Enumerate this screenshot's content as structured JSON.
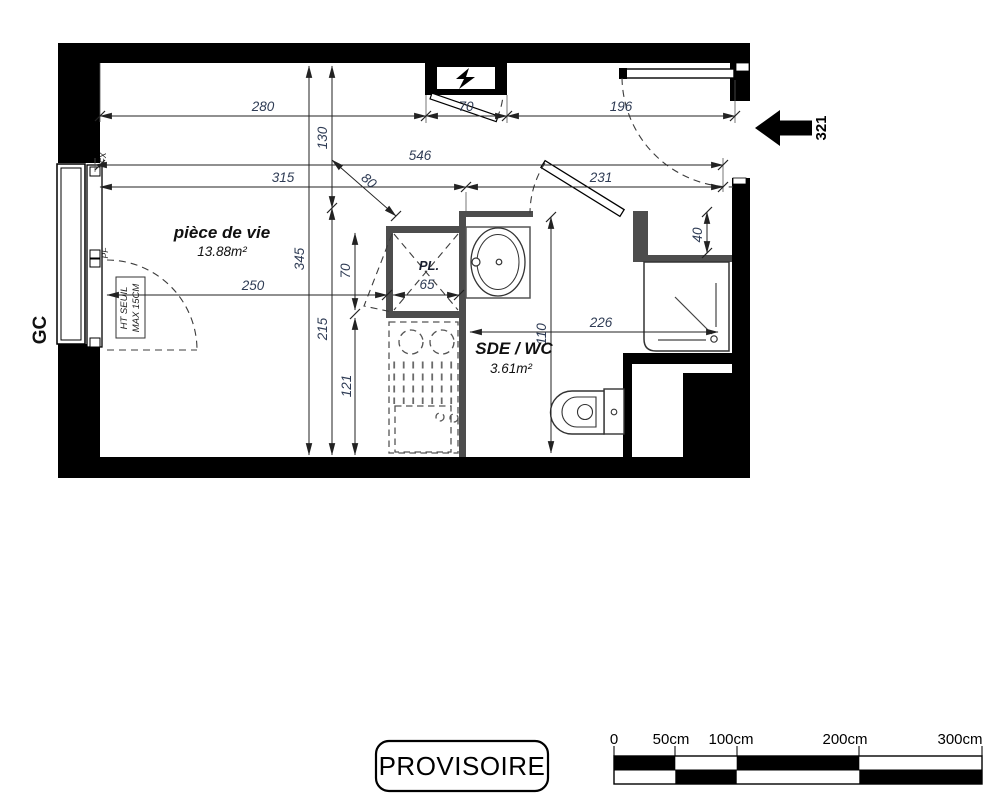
{
  "plan": {
    "rooms": {
      "living": {
        "name": "pièce de vie",
        "area": "13.88m²"
      },
      "bathroom": {
        "name": "SDE / WC",
        "area": "3.61m²"
      }
    },
    "closet": {
      "label": "PL.",
      "width": "65"
    },
    "dims": {
      "w280": "280",
      "w70": "70",
      "w196": "196",
      "w546": "546",
      "w315": "315",
      "w231": "231",
      "w250": "250",
      "w226": "226",
      "h130": "130",
      "h345": "345",
      "h215": "215",
      "h70": "70",
      "h121": "121",
      "h110": "110",
      "h40": "40",
      "diag80": "80"
    },
    "entrance": {
      "unit_number": "321"
    },
    "annotations": {
      "gc": "GC",
      "fx": "FX",
      "pf": "PF",
      "threshold_line1": "HT SEUIL",
      "threshold_line2": "MAX 15CM"
    }
  },
  "stamp": {
    "label": "PROVISOIRE"
  },
  "scale_bar": {
    "labels": [
      "0",
      "50cm",
      "100cm",
      "200cm",
      "300cm"
    ]
  }
}
